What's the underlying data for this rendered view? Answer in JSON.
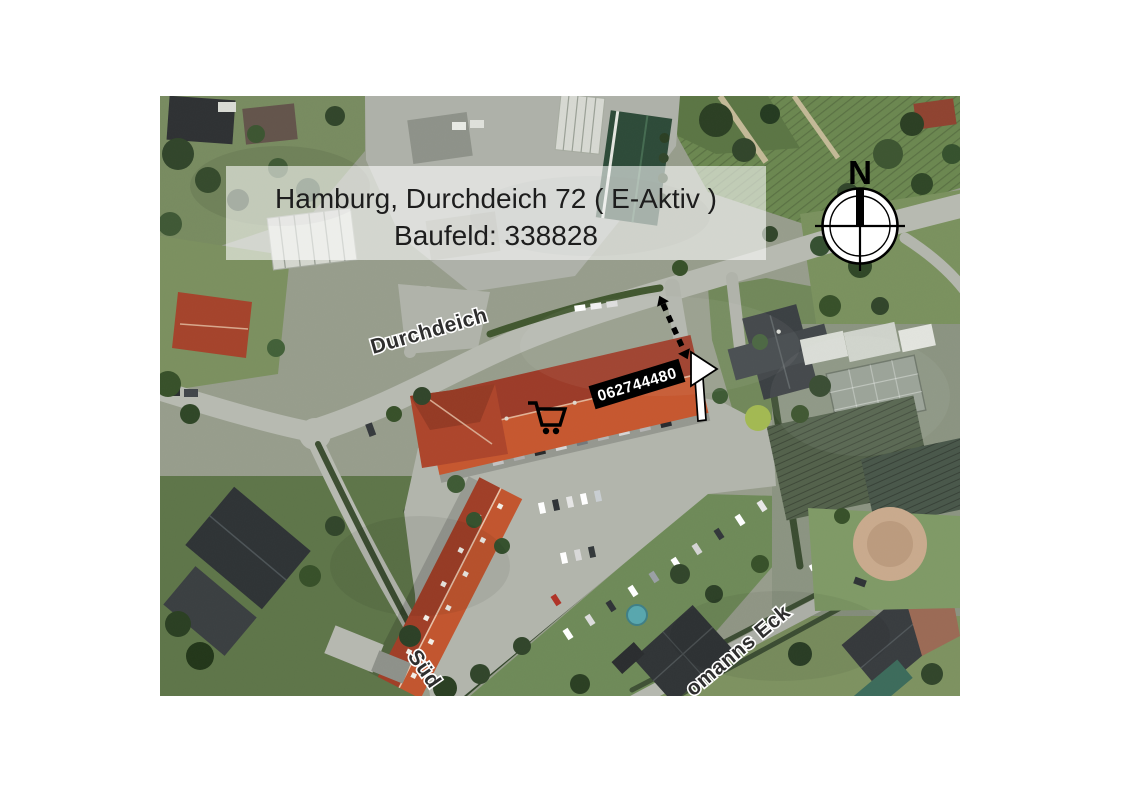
{
  "page": {
    "background_color": "#ffffff"
  },
  "map": {
    "type": "satellite-aerial-photo",
    "title_overlay": {
      "line1": "Hamburg, Durchdeich 72 ( E-Aktiv )",
      "line2": "Baufeld: 338828",
      "box_color": "#ffffff",
      "box_opacity": "0.58",
      "text_color": "#1d1d1d"
    },
    "compass": {
      "north_label": "N",
      "icon": "compass-north-icon",
      "color": "#000000"
    },
    "marker": {
      "store_number": "062744480",
      "background_color": "#000000",
      "text_color": "#ffffff",
      "cart_icon": "shopping-cart-icon",
      "entrance_arrow_icon": "entrance-arrow-icon",
      "dashed_route_icon": "dashed-route-arrow-icon"
    },
    "street_labels": {
      "main": "Durchdeich",
      "south_partial": "Süd",
      "corner_partial": "omanns Eck",
      "text_color": "#2e2e2e",
      "halo_color": "#ffffff"
    },
    "terrain_colors": {
      "road": "#b7bab1",
      "parking": "#b2b5ac",
      "grass": "#7d9464",
      "trees": "#31452a",
      "market_roof_dark": "#9c3b28",
      "market_roof_light": "#c6572f",
      "house_roof_dark": "#34393b",
      "field": "#6b8750",
      "sand_circle": "#c9aa8d"
    }
  }
}
